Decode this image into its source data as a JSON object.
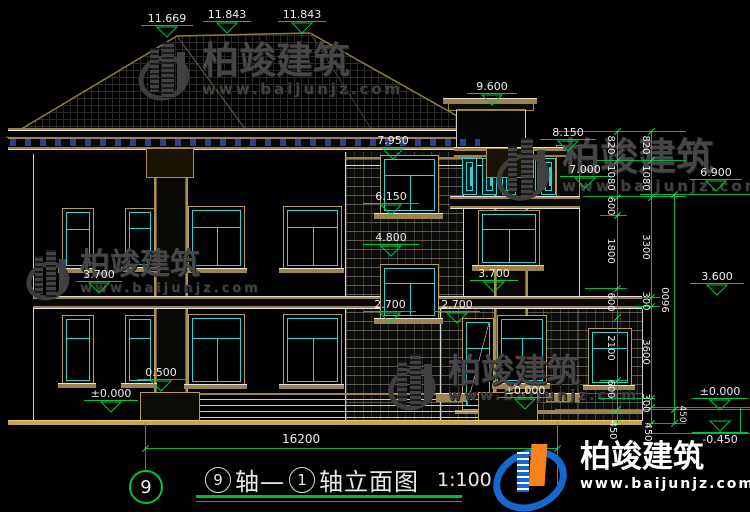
{
  "watermarks": {
    "brand": "柏竣建筑",
    "site": "www.baijunjz.com"
  },
  "footer_logo": {
    "brand": "柏竣建筑",
    "site": "www.baijunjz.com"
  },
  "axis_bubble": "9",
  "drawing_title": {
    "bubble_left": "9",
    "word_left": "轴—",
    "bubble_right": "1",
    "word_right": "轴立面图",
    "scale": "1:100"
  },
  "bottom_dim": "16200",
  "elevation_marks": [
    {
      "id": "roof-hip-left",
      "label": "11.669"
    },
    {
      "id": "ridge-left",
      "label": "11.843"
    },
    {
      "id": "ridge-right",
      "label": "11.843"
    },
    {
      "id": "chimney-top",
      "label": "9.600"
    },
    {
      "id": "balcony-parapet",
      "label": "8.150"
    },
    {
      "id": "tower-cornice",
      "label": "7.950"
    },
    {
      "id": "balcony-floor",
      "label": "7.000"
    },
    {
      "id": "eave-right",
      "label": "6.900"
    },
    {
      "id": "tower-window-upper",
      "label": "6.150"
    },
    {
      "id": "tower-window-mid",
      "label": "4.800"
    },
    {
      "id": "floor2-left",
      "label": "3.700"
    },
    {
      "id": "floor2-right",
      "label": "3.700"
    },
    {
      "id": "wing-roof-right",
      "label": "3.600"
    },
    {
      "id": "sill-tower",
      "label": "2.700"
    },
    {
      "id": "sill-wing",
      "label": "2.700"
    },
    {
      "id": "porch-platform",
      "label": "0.500"
    },
    {
      "id": "ground-left",
      "label": "±0.000"
    },
    {
      "id": "ground-mid",
      "label": "±0.000"
    },
    {
      "id": "ground-right",
      "label": "±0.000"
    },
    {
      "id": "site-level",
      "label": "-0.450"
    }
  ],
  "dim_chains": {
    "col_a": [
      "820",
      "1080",
      "600",
      "1800",
      "600",
      "2100",
      "600",
      "450"
    ],
    "col_b": [
      "820",
      "1080",
      "3300",
      "300",
      "3600",
      "300",
      "450"
    ],
    "col_c": [
      "9600",
      "450"
    ]
  }
}
